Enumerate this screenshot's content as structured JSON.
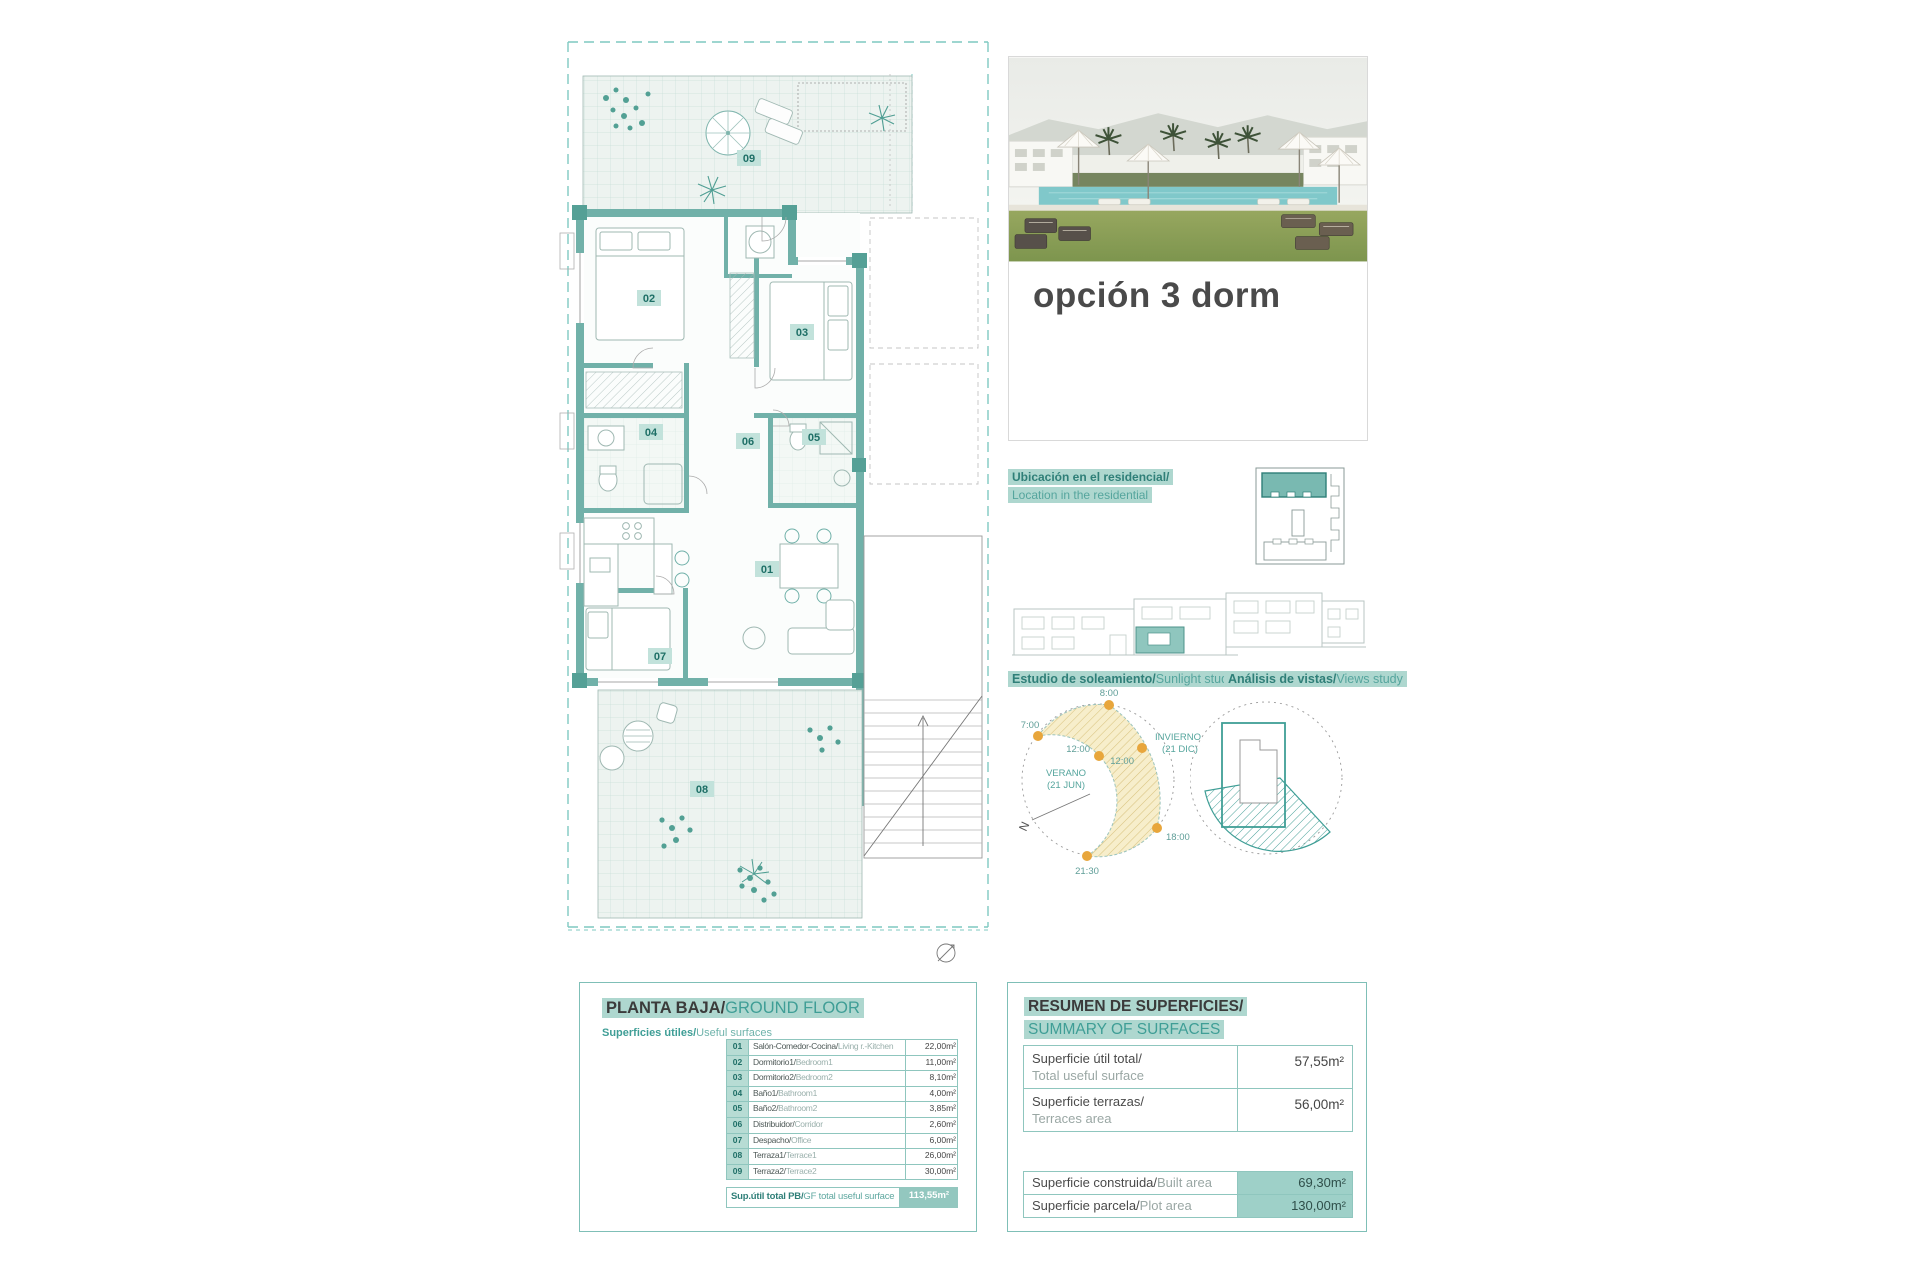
{
  "colors": {
    "accent": "#3f9e96",
    "accent_dark": "#2f7f78",
    "highlight": "#aed7cf",
    "wall": "#6fb0a8",
    "table_border": "#8fc6be",
    "value_fill": "#9ed0c8",
    "sun_dot": "#e8a63c",
    "sun_band": "#f7eecb"
  },
  "photo_card": {
    "title": "opción 3 dorm"
  },
  "location_section": {
    "label_es": "Ubicación en el residencial/",
    "label_en": "Location in the residential"
  },
  "sunlight_section": {
    "label_es": "Estudio de soleamiento/",
    "label_en": "Sunlight study",
    "t7": "7:00",
    "t8": "8:00",
    "t12_summer": "12:00",
    "t12_winter": "12:00",
    "t18": "18:00",
    "t2130": "21:30",
    "winter_1": "INVIERNO",
    "winter_2": "(21 DIC)",
    "summer_1": "VERANO",
    "summer_2": "(21 JUN)",
    "north": "N"
  },
  "views_section": {
    "label_es": "Análisis de vistas/",
    "label_en": "Views study"
  },
  "floor_plan": {
    "rooms": {
      "r01": "01",
      "r02": "02",
      "r03": "03",
      "r04": "04",
      "r05": "05",
      "r06": "06",
      "r07": "07",
      "r08": "08",
      "r09": "09"
    }
  },
  "ground_floor": {
    "title_es": "PLANTA BAJA/",
    "title_en": "GROUND FLOOR",
    "subtitle_es": "Superficies útiles/",
    "subtitle_en": "Useful surfaces",
    "rows": [
      {
        "num": "01",
        "es": "Salón-Comedor-Cocina/",
        "en": "Living r.-Kitchen",
        "area": "22,00m²"
      },
      {
        "num": "02",
        "es": "Dormitorio1/",
        "en": "Bedroom1",
        "area": "11,00m²"
      },
      {
        "num": "03",
        "es": "Dormitorio2/",
        "en": "Bedroom2",
        "area": "8,10m²"
      },
      {
        "num": "04",
        "es": "Baño1/",
        "en": "Bathroom1",
        "area": "4,00m²"
      },
      {
        "num": "05",
        "es": "Baño2/",
        "en": "Bathroom2",
        "area": "3,85m²"
      },
      {
        "num": "06",
        "es": "Distribuidor/",
        "en": "Corridor",
        "area": "2,60m²"
      },
      {
        "num": "07",
        "es": "Despacho/",
        "en": "Office",
        "area": "6,00m²"
      },
      {
        "num": "08",
        "es": "Terraza1/",
        "en": "Terrace1",
        "area": "26,00m²"
      },
      {
        "num": "09",
        "es": "Terraza2/",
        "en": "Terrace2",
        "area": "30,00m²"
      }
    ],
    "total_es": "Sup.útil total PB/",
    "total_en": "GF total useful surface",
    "total_area": "113,55m²"
  },
  "summary": {
    "title_es": "RESUMEN DE SUPERFICIES/",
    "title_en": "SUMMARY OF SURFACES",
    "rows_top": [
      {
        "es": "Superficie útil total/",
        "en": "Total useful surface",
        "area": "57,55m²"
      },
      {
        "es": "Superficie terrazas/",
        "en": "Terraces area",
        "area": "56,00m²"
      }
    ],
    "rows_bottom": [
      {
        "es": "Superficie construida/",
        "en": "Built area",
        "area": "69,30m²"
      },
      {
        "es": "Superficie parcela/",
        "en": "Plot area",
        "area": "130,00m²"
      }
    ]
  }
}
